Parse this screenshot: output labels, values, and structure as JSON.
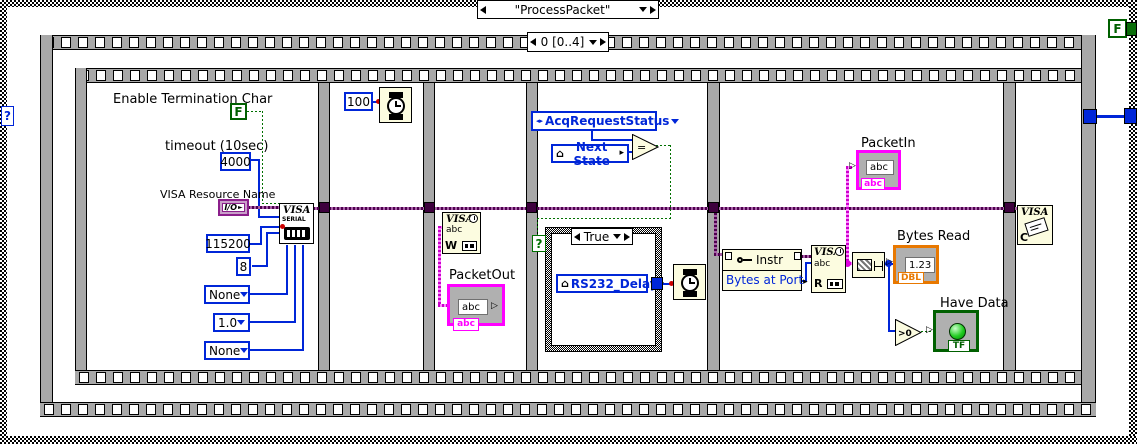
{
  "window": {
    "case_selector": "\"ProcessPacket\"",
    "sequence_selector": "0 [0..4]",
    "case_terminal_q": "?",
    "true_constant": "F"
  },
  "frame1": {
    "enable_label": "Enable Termination Char",
    "enable_value": "F",
    "timeout_label": "timeout (10sec)",
    "timeout_value": "4000",
    "visa_label": "VISA Resource Name",
    "visa_io": "I/O",
    "baud": "115200",
    "data_bits": "8",
    "parity": "None",
    "stop_bits": "1.0",
    "flow_control": "None",
    "visa_serial_title": "VISA",
    "visa_serial_sub": "SERIAL"
  },
  "frame2": {
    "wait_ms": "100"
  },
  "frame3": {
    "visa_title": "VISA",
    "visa_abc": "abc",
    "visa_w": "W",
    "packet_out_label": "PacketOut",
    "packet_out_value": "abc",
    "packet_out_tag": "abc"
  },
  "frame4": {
    "enum_value": "AcqRequestStatus",
    "local_next_state": "Next State",
    "equals": "=",
    "case_selector": "True",
    "case_terminal_q": "?",
    "global_rs232": "RS232_Delay"
  },
  "frame5": {
    "prop_class": "Instr",
    "prop_item": "Bytes at Port",
    "visa_title": "VISA",
    "visa_abc": "abc",
    "visa_r": "R",
    "packet_in_label": "PacketIn",
    "packet_in_value": "abc",
    "packet_in_tag": "abc",
    "bytes_read_label": "Bytes Read",
    "bytes_read_value": "1.23",
    "bytes_read_tag": "DBL",
    "greater_than_zero": ">0",
    "have_data_label": "Have Data",
    "have_data_tag": "TF"
  },
  "frame6": {
    "visa_title": "VISA",
    "visa_c": "C"
  },
  "icons": {
    "global_house": "⌂",
    "output_arrow": "▸",
    "input_arrow": "▷",
    "enum_arrows": "◂▸",
    "io_arrow": "►"
  },
  "colors": {
    "visa_wire": "#4d004d",
    "string_wire": "#ff00ff",
    "int_wire": "#0026d8",
    "bool_wire": "#007000",
    "string_accent": "#ff00ff",
    "numeric_accent": "#e87800",
    "bool_accent": "#006000",
    "node_fill": "#fcfce0"
  }
}
